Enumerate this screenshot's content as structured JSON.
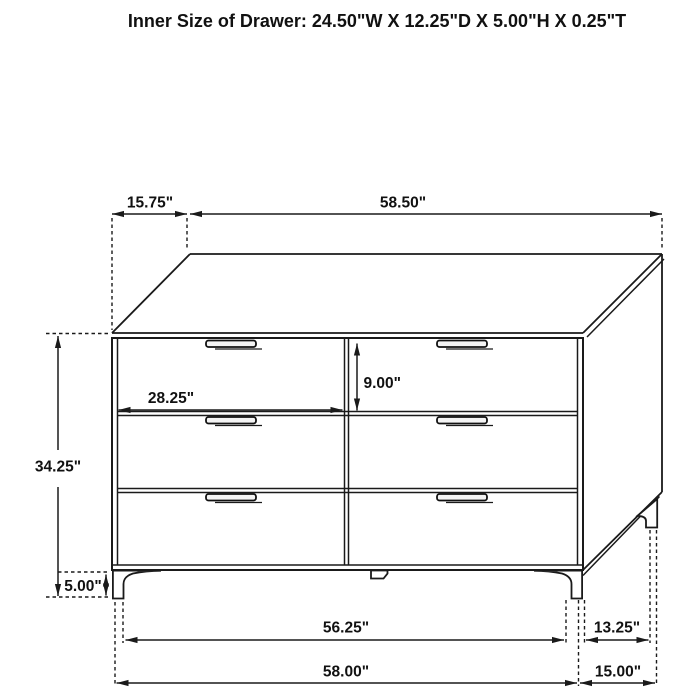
{
  "title": "Inner Size of Drawer: 24.50\"W X 12.25\"D X 5.00\"H X 0.25\"T",
  "figure": "six-drawer dresser dimension diagram",
  "colors": {
    "line": "#1a1a1a",
    "background": "#ffffff"
  },
  "dimensions": {
    "back_offset": "15.75\"",
    "top_width": "58.50\"",
    "overall_height": "34.25\"",
    "leg_height": "5.00\"",
    "drawer_width": "28.25\"",
    "drawer_height": "9.00\"",
    "footprint_inner_width": "56.25\"",
    "footprint_width": "58.00\"",
    "footprint_inner_depth": "13.25\"",
    "footprint_depth": "15.00\""
  }
}
